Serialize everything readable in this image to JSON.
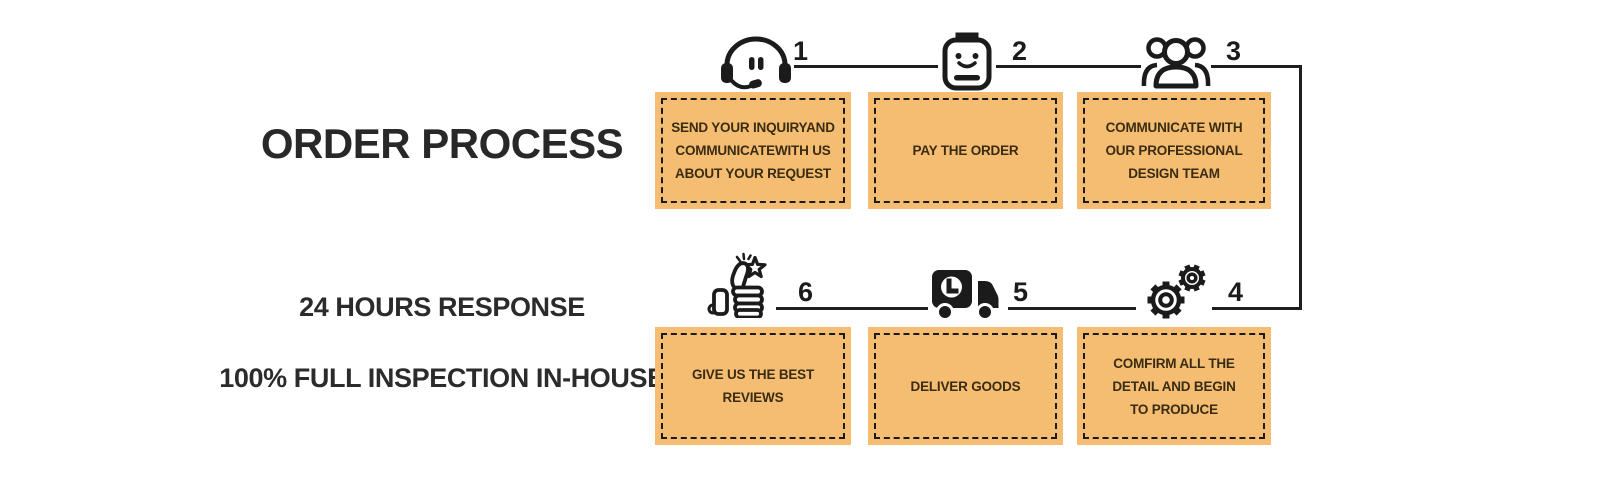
{
  "title": "ORDER PROCESS",
  "taglines": {
    "response": "24 HOURS RESPONSE",
    "inspection": "100% FULL INSPECTION IN-HOUSE"
  },
  "colors": {
    "box_fill": "#F5BD72",
    "box_border": "#1a1a1a",
    "box_text": "#3a2c13",
    "line": "#1e1e1e",
    "heading_text": "#282828"
  },
  "steps": [
    {
      "number": "1",
      "icon": "headset-icon",
      "lines": [
        "SEND YOUR INQUIRYAND",
        "COMMUNICATEWITH US",
        "ABOUT YOUR REQUEST"
      ]
    },
    {
      "number": "2",
      "icon": "notepad-smiley-icon",
      "lines": [
        "PAY THE ORDER"
      ]
    },
    {
      "number": "3",
      "icon": "design-team-icon",
      "lines": [
        "COMMUNICATE WITH",
        "OUR PROFESSIONAL",
        "DESIGN TEAM"
      ]
    },
    {
      "number": "4",
      "icon": "gears-icon",
      "lines": [
        "COMFIRM ALL THE",
        "DETAIL AND BEGIN",
        "TO PRODUCE"
      ]
    },
    {
      "number": "5",
      "icon": "delivery-truck-icon",
      "lines": [
        "DELIVER GOODS"
      ]
    },
    {
      "number": "6",
      "icon": "thumbs-up-star-icon",
      "lines": [
        "GIVE US THE BEST",
        "REVIEWS"
      ]
    }
  ]
}
